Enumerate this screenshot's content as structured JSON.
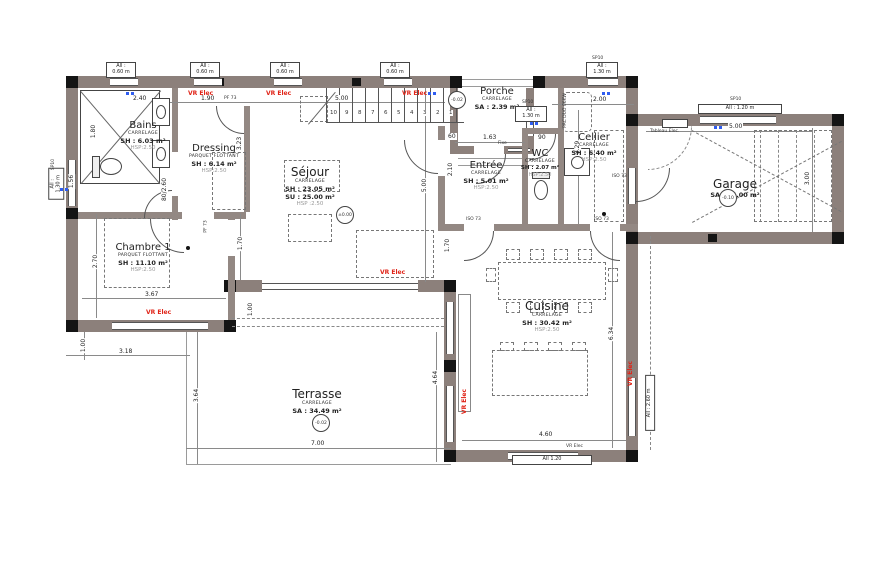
{
  "drawing_type": "house floor plan (rez-de-chaussée)",
  "colors": {
    "wall": "#8c807b",
    "post": "#141414",
    "vr_elec_red": "#e02418",
    "window_blue": "#2f5df0"
  },
  "rooms": {
    "bains": {
      "name": "Bains",
      "finish": "CARRELAGE",
      "area": "SH : 6.03 m²",
      "hsp": "HSP:2.50"
    },
    "dressing": {
      "name": "Dressing",
      "finish": "PARQUET FLOTTANT",
      "area": "SH : 6.14 m²",
      "hsp": "HSP:2.50"
    },
    "chambre": {
      "name": "Chambre 1",
      "finish": "PARQUET FLOTTANT",
      "area": "SH : 11.10 m²",
      "hsp": "HSP:2.50"
    },
    "sejour": {
      "name": "Séjour",
      "finish": "CARRELAGE",
      "area": "SH : 23.05 m²",
      "area2": "SU : 25.00 m²",
      "hsp": "HSP :2.50"
    },
    "porche": {
      "name": "Porche",
      "finish": "CARRELAGE",
      "area": "SA : 2.39 m²"
    },
    "entree": {
      "name": "Entrée",
      "finish": "CARRELAGE",
      "area": "SH : 5.01 m²",
      "hsp": "HSP:2.50"
    },
    "wc": {
      "name": "WC",
      "finish": "CARRELAGE",
      "area": "SH : 2.07 m²",
      "hsp": "HSP:2.50"
    },
    "cellier": {
      "name": "Cellier",
      "finish": "CARRELAGE",
      "area": "SH : 6.40 m²",
      "hsp": "HSP:2.50"
    },
    "garage": {
      "name": "Garage",
      "area": "SA : 15.00 m²"
    },
    "cuisine": {
      "name": "Cuisine",
      "finish": "CARRELAGE",
      "area": "SH : 30.42 m²",
      "hsp": "HSP:2.50"
    },
    "terrasse": {
      "name": "Terrasse",
      "finish": "CARRELAGE",
      "area": "SA : 34.49 m²"
    }
  },
  "levels": {
    "sejour": "±0.00",
    "porche": "-0.02",
    "terrasse": "-0.02",
    "garage": "-0.10"
  },
  "dimensions": {
    "top_bains": "2.40",
    "top_dressing": "1.90",
    "top_sejour": "5.00",
    "entree_w": "1.63",
    "cellier_w": "2.00",
    "garage_w": "5.00",
    "garage_h": "3.00",
    "bains_h": "1.80",
    "wc_side": "1.56",
    "dressing_h": "3.23",
    "door_bains": "80/2.60",
    "chambre_h": "2.70",
    "chambre_w": "3.67",
    "offset_left": "1.00",
    "terrasse_left_w": "3.18",
    "sejour_chambre": "1.70",
    "bay_offset": "1.00",
    "sejour_h": "5.00",
    "door60": "60",
    "door90": "90",
    "entree_h": "2.10",
    "cellier_h": "3.29",
    "cuisine_top": "1.70",
    "cuisine_h": "6.34",
    "terrasse_right_h": "4.64",
    "terrasse_left_h": "3.64",
    "terrasse_w": "7.00",
    "cuisine_w": "4.60"
  },
  "windows": {
    "w060": {
      "l1": "All :",
      "l2": "0.60 m"
    },
    "w130": {
      "l1": "All :",
      "l2": "1.30 m"
    },
    "w120_garage": "All : 1.20 m",
    "w120_cuisine": "All 1.20",
    "w260": "All : 2.60 m"
  },
  "labels": {
    "vr_elec": "VR Elec",
    "sp10": "SP10",
    "pf73": "PF 73",
    "iso73": "ISO 73",
    "fixe": "Fixe",
    "tableau_elec": "Tableau Elec.",
    "pac": "PAC DUO 06KW"
  },
  "stairs": {
    "steps": [
      "1",
      "2",
      "3",
      "4",
      "5",
      "6",
      "7",
      "8",
      "9",
      "10"
    ]
  }
}
